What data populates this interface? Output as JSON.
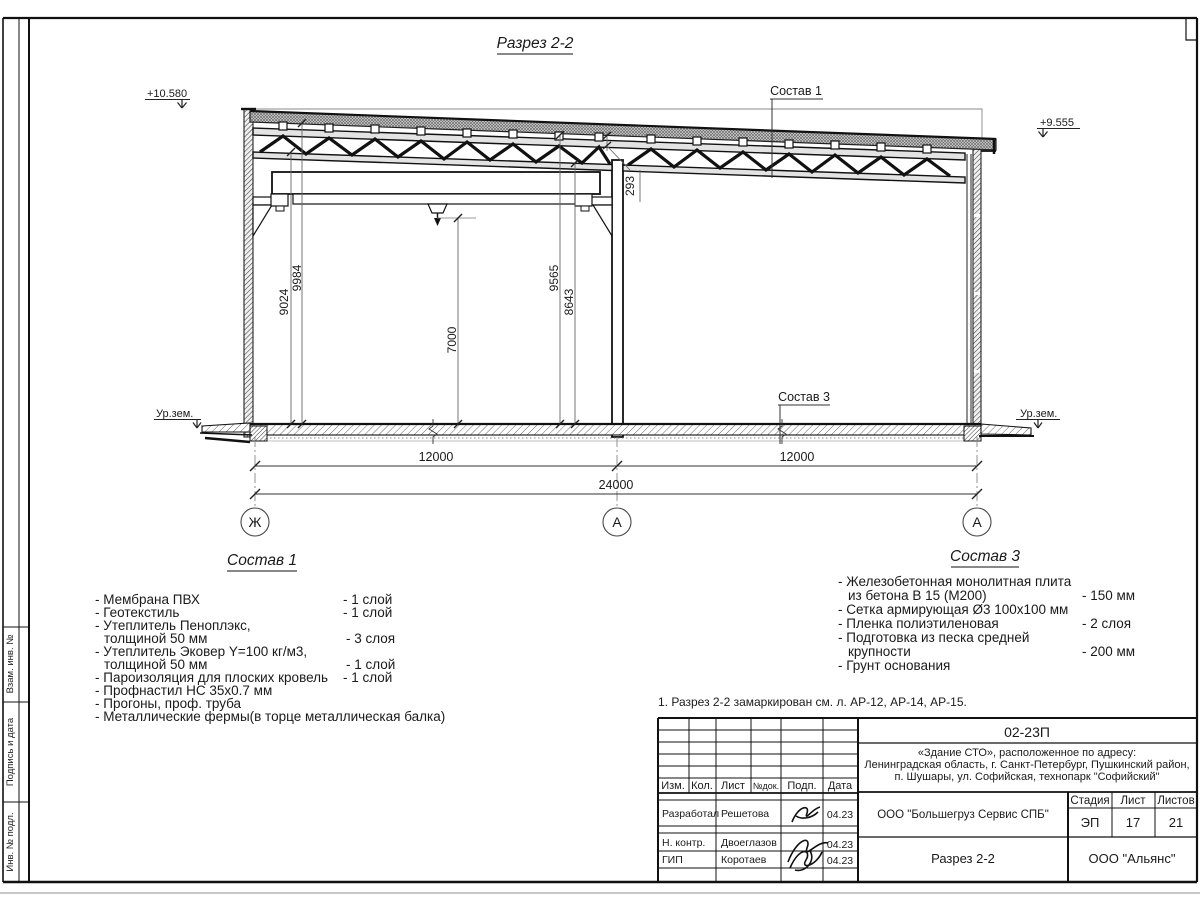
{
  "sheet": {
    "title": "Разрез 2-2",
    "note": "1. Разрез 2-2 замаркирован см. л. АР-12, АР-14, АР-15.",
    "edge_labels": [
      "Взам. инв. №",
      "Подпись и дата",
      "Инв. № подл."
    ]
  },
  "section": {
    "elevations": {
      "left": "+10.580",
      "right": "+9.555"
    },
    "ground": {
      "left": "Ур.зем.",
      "right": "Ур.зем."
    },
    "callouts": {
      "roof": "Состав 1",
      "floor": "Состав 3"
    },
    "dims": {
      "h1": "9024",
      "h2": "9984",
      "h3": "7000",
      "h4": "9565",
      "h5": "8643",
      "gap": "293",
      "bay_left": "12000",
      "bay_right": "12000",
      "total": "24000"
    },
    "axes": {
      "left": "Ж",
      "middle": "А",
      "right": "А"
    }
  },
  "sostav1": {
    "heading": "Состав 1",
    "items": [
      {
        "name": "- Мембрана ПВХ",
        "value": "- 1 слой"
      },
      {
        "name": "- Геотекстиль",
        "value": "- 1 слой"
      },
      {
        "name": "- Утеплитель Пеноплэкс,",
        "value": ""
      },
      {
        "name": "толщиной 50 мм",
        "value": "- 3 слоя"
      },
      {
        "name": "- Утеплитель Эковер Y=100 кг/м3,",
        "value": ""
      },
      {
        "name": "толщиной 50 мм",
        "value": "- 1 слой"
      },
      {
        "name": "- Пароизоляция для плоских кровель",
        "value": "- 1 слой"
      },
      {
        "name": "- Профнастил НС 35х0.7 мм",
        "value": ""
      },
      {
        "name": "- Прогоны, проф. труба",
        "value": ""
      },
      {
        "name": "- Металлические фермы(в торце металлическая балка)",
        "value": ""
      }
    ]
  },
  "sostav3": {
    "heading": "Состав 3",
    "items": [
      {
        "name": "- Железобетонная  монолитная плита",
        "value": ""
      },
      {
        "name": "из бетона В 15 (М200)",
        "value": "- 150 мм"
      },
      {
        "name": "- Сетка армирующая Ø3 100х100 мм",
        "value": ""
      },
      {
        "name": "- Пленка полиэтиленовая",
        "value": "-  2 слоя"
      },
      {
        "name": "- Подготовка из песка средней",
        "value": ""
      },
      {
        "name": "крупности",
        "value": "- 200 мм"
      },
      {
        "name": "- Грунт основания",
        "value": ""
      }
    ]
  },
  "titleblock": {
    "doc_number": "02-23П",
    "object": [
      "«Здание СТО», расположенное по адресу:",
      "Ленинградская область, г. Санкт-Петербург, Пушкинский район,",
      "п. Шушары, ул. Софийская, технопарк \"Софийский\""
    ],
    "columns": [
      "Изм.",
      "Кол.",
      "Лист",
      "№док.",
      "Подп.",
      "Дата"
    ],
    "rows": [
      {
        "role": "Разработал",
        "name": "Решетова",
        "date": "04.23"
      },
      {
        "role": "Н. контр.",
        "name": "Двоеглазов",
        "date": "04.23"
      },
      {
        "role": "ГИП",
        "name": "Коротаев",
        "date": "04.23"
      }
    ],
    "company": "ООО \"Большегруз Сервис СПБ\"",
    "drawing_title": "Разрез 2-2",
    "stage_label": "Стадия",
    "sheet_label": "Лист",
    "sheets_label": "Листов",
    "stage": "ЭП",
    "sheet_no": "17",
    "sheets_total": "21",
    "org": "ООО \"Альянс\""
  }
}
